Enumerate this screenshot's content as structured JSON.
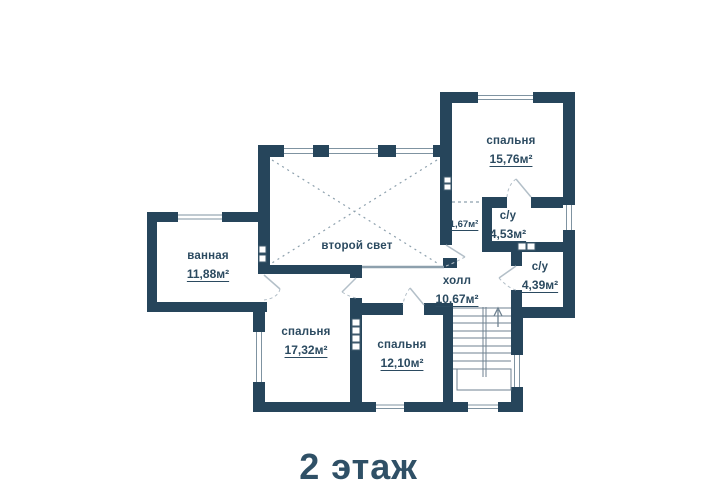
{
  "title": "2 этаж",
  "colors": {
    "wall": "#26455b",
    "text": "#2b4a60",
    "thin_line": "#8da0ad"
  },
  "rooms": [
    {
      "name": "спальня",
      "area": "15,76м²"
    },
    {
      "name": "с/у",
      "area": "4,53м²"
    },
    {
      "name": "с/у",
      "area": "4,39м²"
    },
    {
      "name": "",
      "area": "1,67м²"
    },
    {
      "name": "ванная",
      "area": "11,88м²"
    },
    {
      "name": "второй свет",
      "area": ""
    },
    {
      "name": "холл",
      "area": "10,67м²"
    },
    {
      "name": "спальня",
      "area": "17,32м²"
    },
    {
      "name": "спальня",
      "area": "12,10м²"
    }
  ]
}
